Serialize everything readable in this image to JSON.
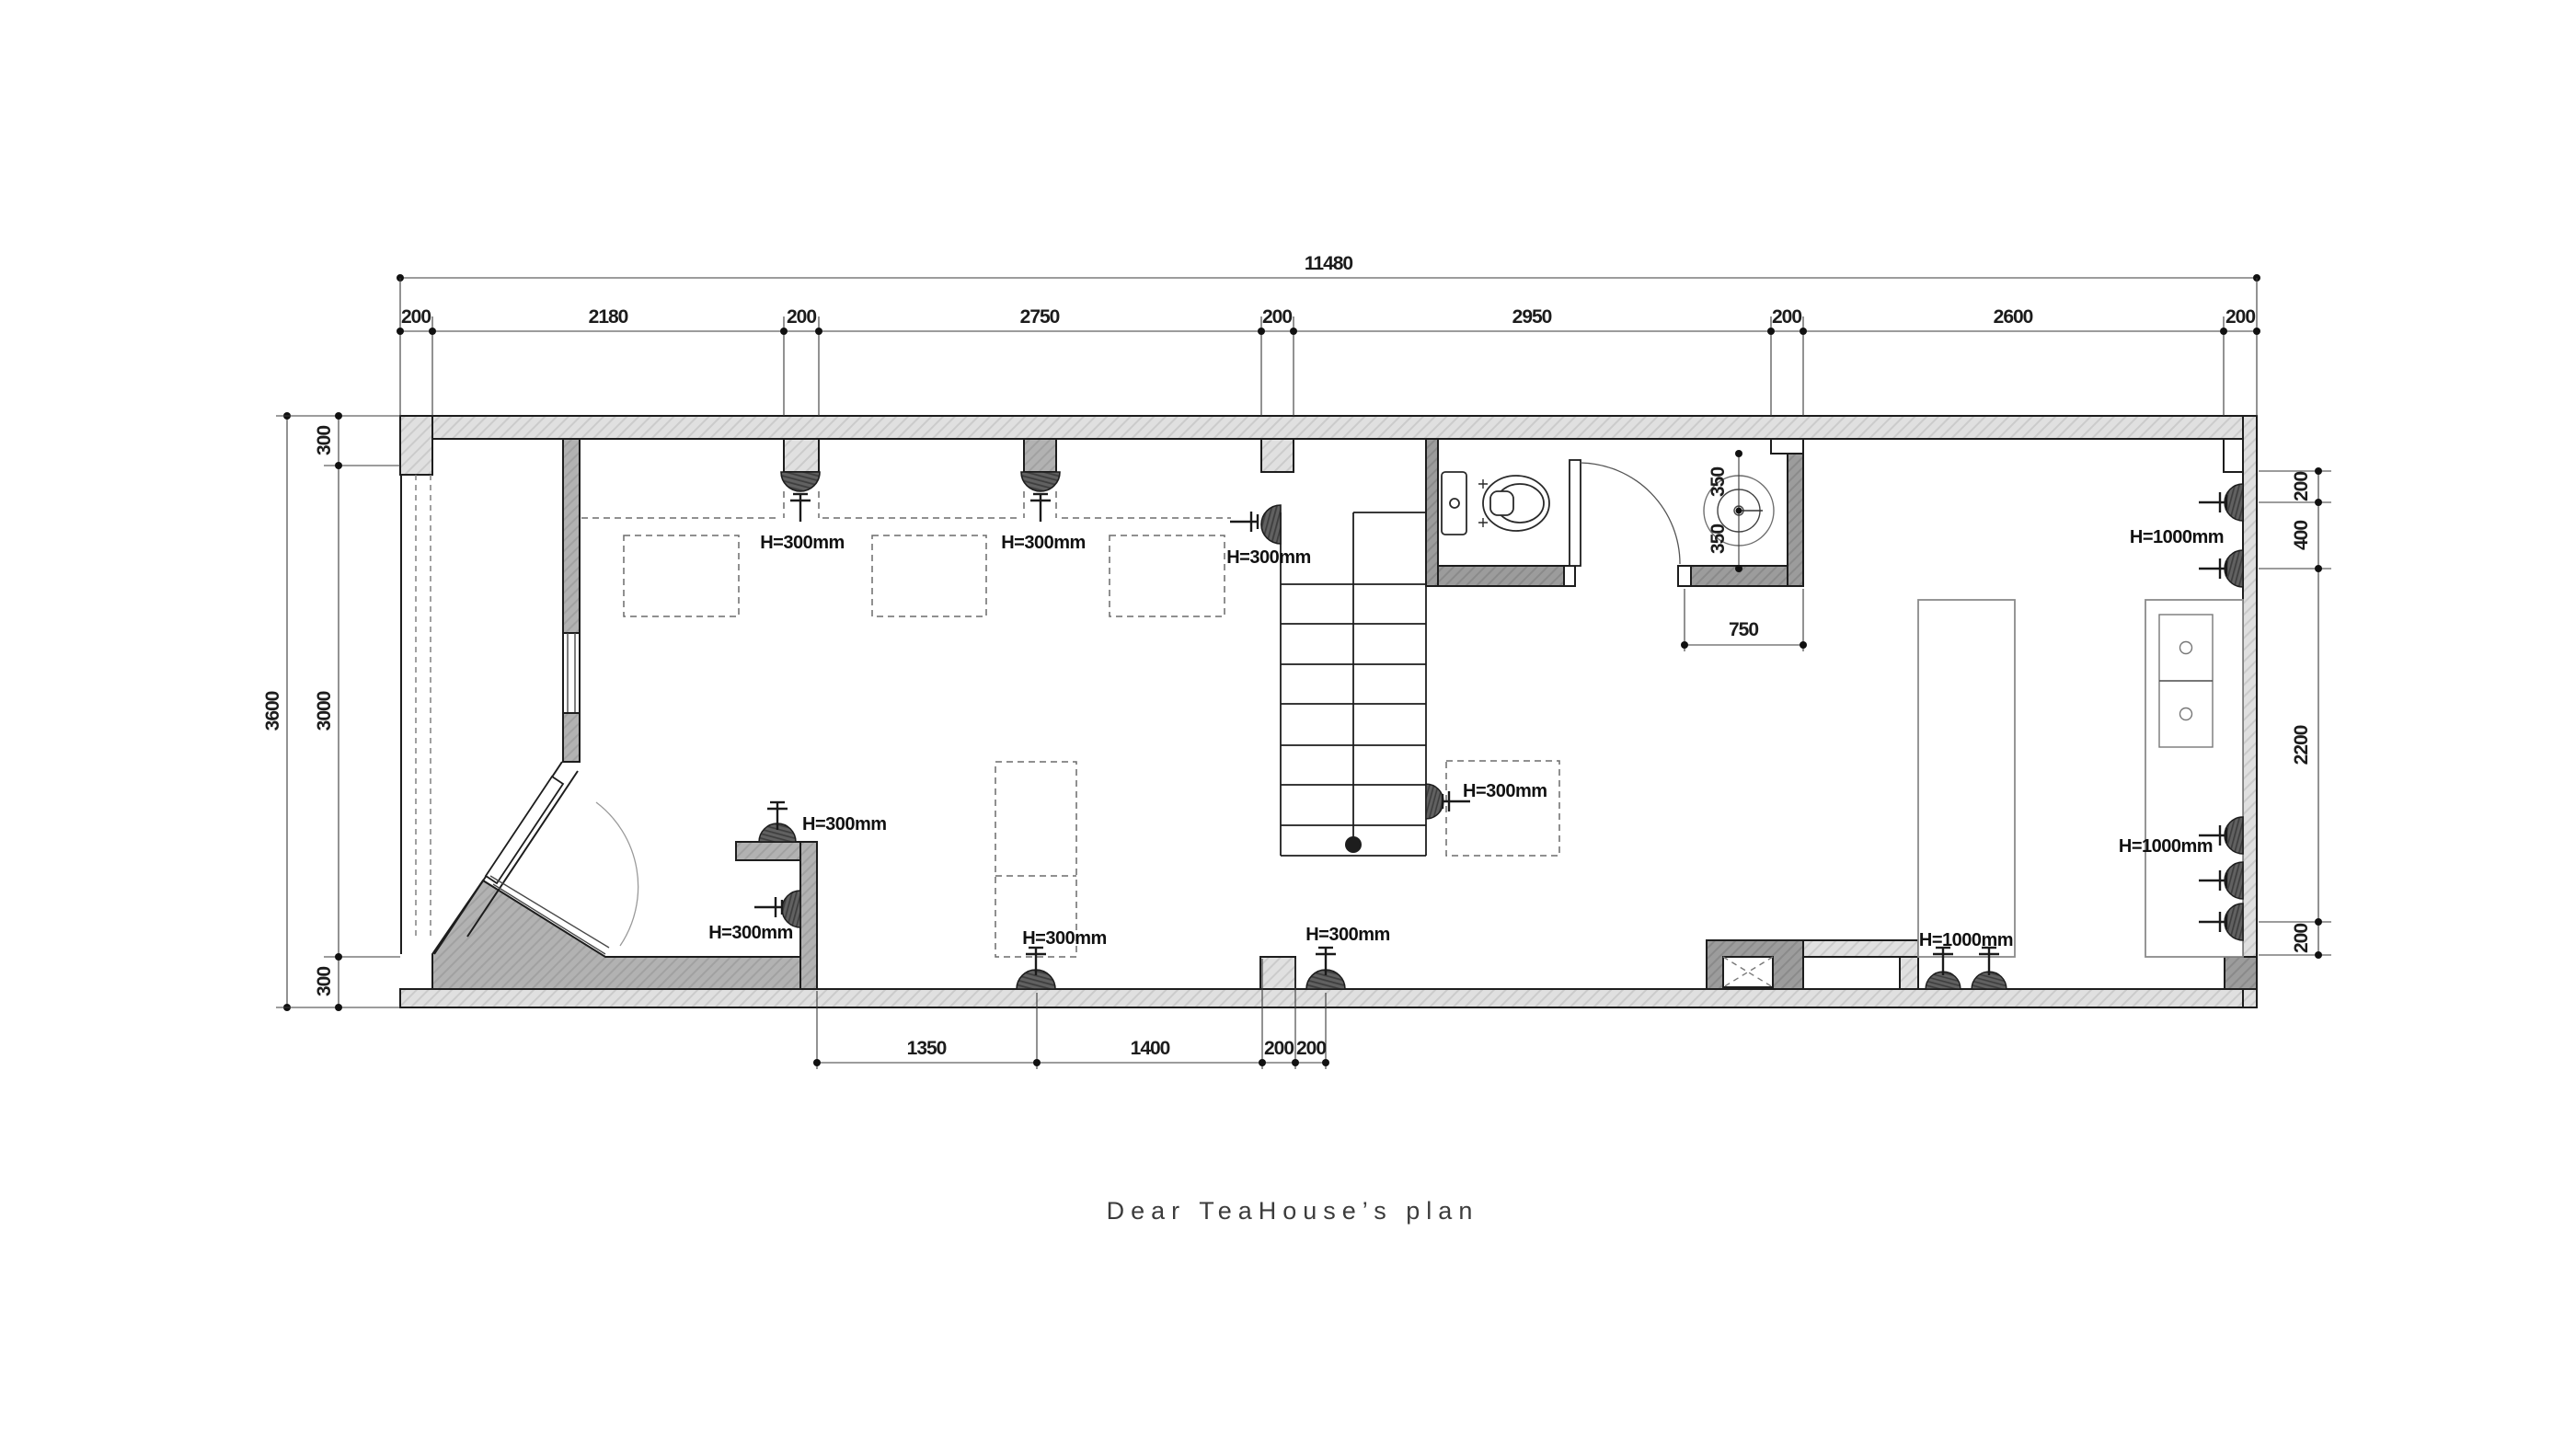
{
  "title": "Dear TeaHouse’s plan",
  "dimensions": {
    "top": {
      "overall": "11480",
      "segments": [
        "200",
        "2180",
        "200",
        "2750",
        "200",
        "2950",
        "200",
        "2600",
        "200"
      ]
    },
    "left": {
      "overall": "3600",
      "segments": [
        "300",
        "3000",
        "300"
      ]
    },
    "right": {
      "segments": [
        "200",
        "400",
        "2200",
        "200"
      ]
    },
    "bottom": {
      "segments": [
        "1350",
        "1400",
        "200",
        "200"
      ]
    },
    "washbasin": {
      "recess": "750",
      "offsets": [
        "350",
        "350"
      ]
    }
  },
  "labels": {
    "h300": [
      "H=300mm",
      "H=300mm",
      "H=300mm",
      "H=300mm",
      "H=300mm",
      "H=300mm",
      "H=300mm",
      "H=300mm"
    ],
    "h1000": [
      "H=1000mm",
      "H=1000mm",
      "H=1000mm"
    ]
  }
}
